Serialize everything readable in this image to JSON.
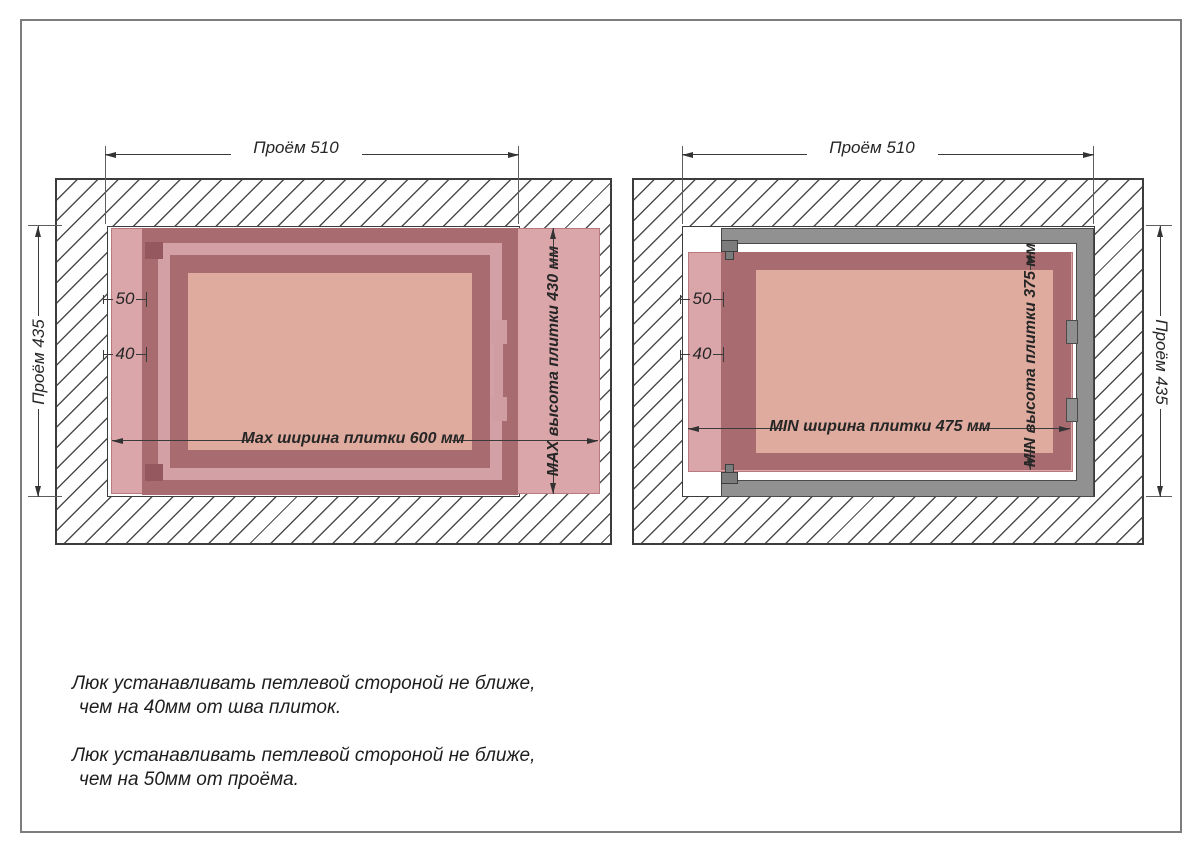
{
  "left": {
    "proem_w": "Проём 510",
    "proem_h": "Проём 435",
    "d50": "50",
    "d40": "40",
    "tile_w": "Мах ширина плитки 600 мм",
    "tile_h": "МАХ высота плитки 430 мм"
  },
  "right": {
    "proem_w": "Проём 510",
    "proem_h": "Проём 435",
    "d50": "50",
    "d40": "40",
    "tile_w": "MIN ширина плитки 475 мм",
    "tile_h": "MIN высота плитки 375 мм"
  },
  "notes": [
    {
      "line1": "Люк устанавливать петлевой стороной не ближе,",
      "line2": "чем на 40мм от шва плиток."
    },
    {
      "line1": "Люк устанавливать петлевой стороной не ближе,",
      "line2": "чем на 50мм от проёма."
    }
  ],
  "colors": {
    "tile_rose": "#dba6a9",
    "frame_dark_rose": "#a76b70",
    "gap_rose": "#d2a0a5",
    "door_panel": "#dfab9e",
    "metal_gray": "#919191",
    "hatch_line": "#4d4d4d"
  }
}
